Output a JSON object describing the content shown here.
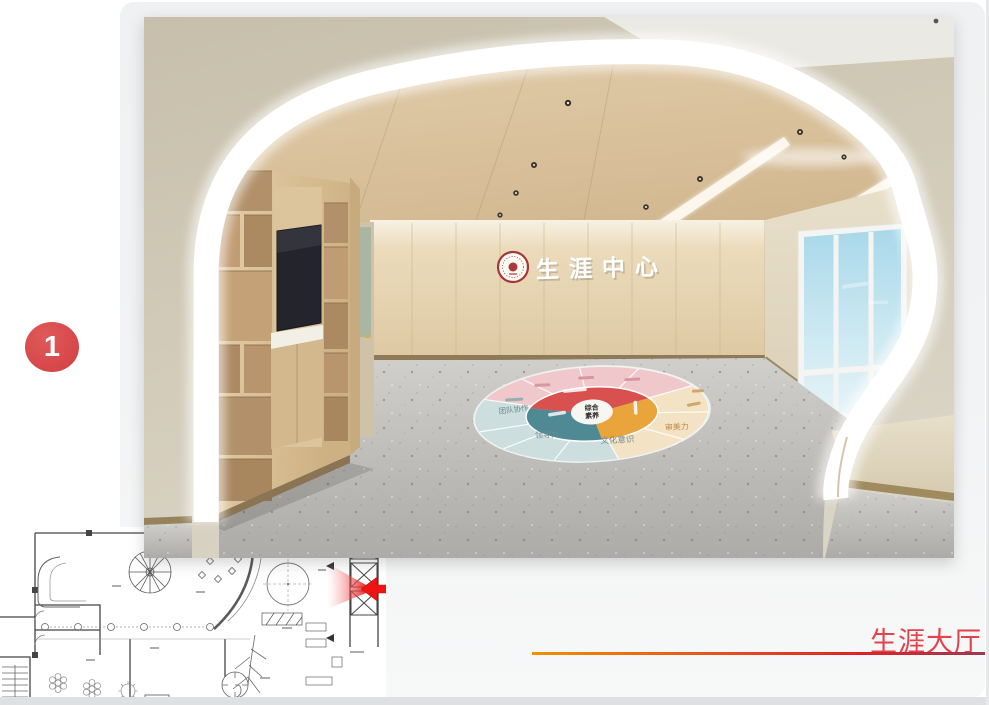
{
  "slide": {
    "background": "#f1f2f3",
    "bottom_strip": "#dee0e2",
    "badge": {
      "number": "1",
      "color": "#d8494c"
    },
    "caption": {
      "text": "生涯大厅",
      "color": "#e4414d"
    }
  },
  "render": {
    "wall_sign": "生涯中心",
    "floor_decal": {
      "center_line1": "综合",
      "center_line2": "素养",
      "labels": {
        "teamwork": "团队协作",
        "leadership": "领导力",
        "culture": "文化意识",
        "aesthetics": "审美力"
      },
      "colors": {
        "pink": "#f0c8cb",
        "cream": "#f3e2c3",
        "blue": "#ccdede",
        "red": "#d8514f",
        "orange": "#e9a43c",
        "teal": "#4e8994"
      }
    }
  },
  "floor_plan": {
    "arrow_color": "#ee1414"
  }
}
